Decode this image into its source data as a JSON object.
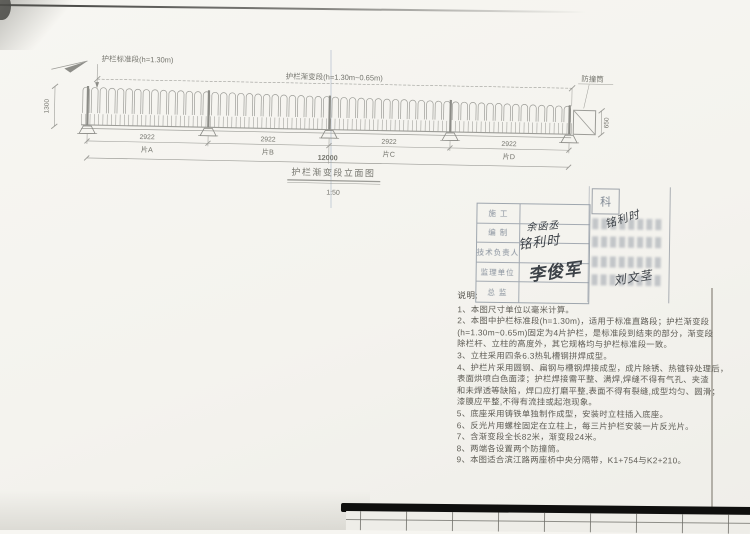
{
  "drawing": {
    "callout_standard": "护栏标准段(h=1.30m)",
    "callout_transition": "护栏渐变段(h=1.30m~0.65m)",
    "callout_barrel": "防撞筒",
    "dim_height_left": "1300",
    "dim_height_right": "650",
    "dim_panels": [
      "2922",
      "2922",
      "2922",
      "2922"
    ],
    "panel_labels": [
      "片A",
      "片B",
      "片C",
      "片D"
    ],
    "dim_total": "12000",
    "title": "护栏渐变段立面图",
    "scale": "1:50"
  },
  "stamp": {
    "row_labels": [
      "施 工",
      "编 制",
      "技术负责人",
      "监理单位",
      "总 监"
    ],
    "corner_cell": "科",
    "signatures": [
      {
        "text": "余函丞"
      },
      {
        "text": "铭利时"
      },
      {
        "text": "铭利时"
      },
      {
        "text": "李俊军"
      },
      {
        "text": "刘文茎"
      }
    ]
  },
  "notes": {
    "heading": "说明:",
    "lines": [
      "1、本图尺寸单位以毫米计算。",
      "2、本图中护栏标准段(h=1.30m)，适用于标准直路段；护栏渐变段",
      "(h=1.30m~0.65m)固定为4片护栏，是标准段到结束的部分，渐变段",
      "除栏杆、立柱的高度外，其它规格均与护栏标准段一致。",
      "3、立柱采用四条6.3热轧槽钢拼焊成型。",
      "4、护栏片采用圆钢、扁钢与槽钢焊接成型，成片除锈、热镀锌处理后，",
      "表面烘喷白色面漆；护栏焊接需平整、满焊,焊缝不得有气孔、夹渣",
      "和未焊透等缺陷，焊口应打磨平整,表面不得有裂缝,成型均匀、圆滑；",
      "漆膜应平整,不得有流挂或起泡现象。",
      "5、底座采用铸铁单独制作成型，安装时立柱插入底座。",
      "6、反光片用螺栓固定在立柱上，每三片护栏安装一片反光片。",
      "7、含渐变段全长82米，渐变段24米。",
      "8、两端各设置两个防撞筒。",
      "9、本图适合滨江路两座桥中央分隔带，K1+754与K2+210。"
    ]
  }
}
